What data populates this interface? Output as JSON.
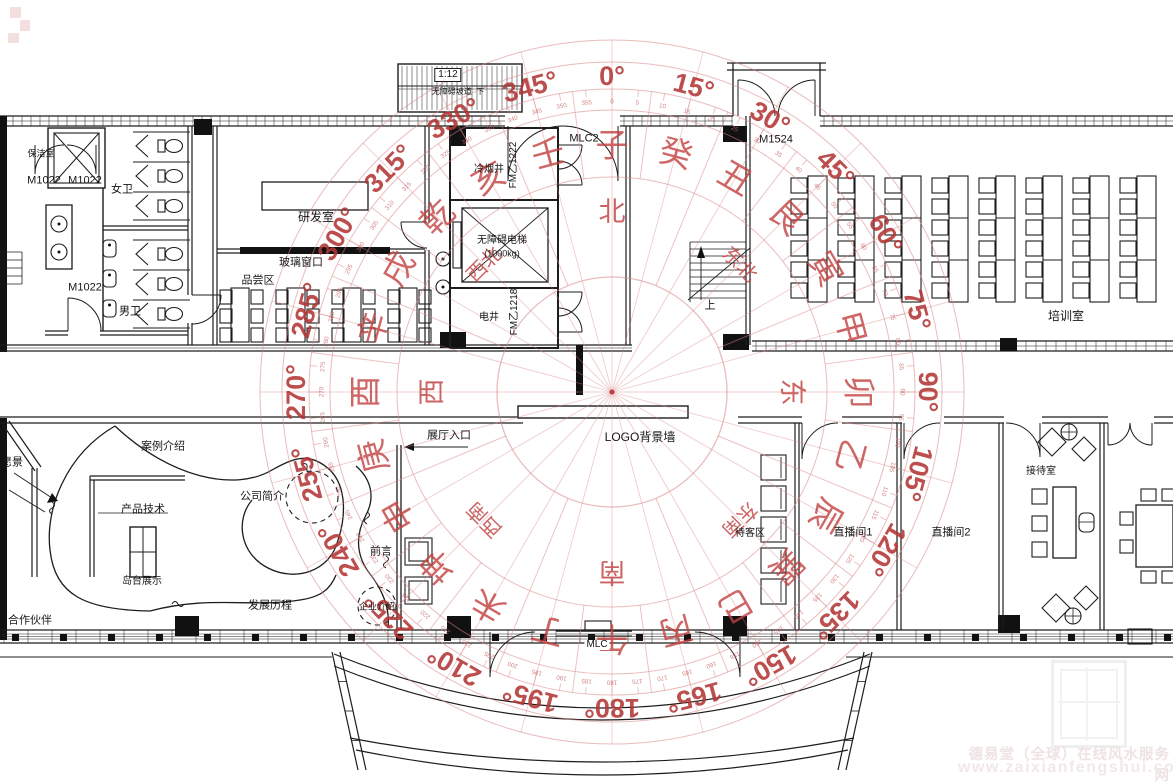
{
  "compass": {
    "center_x": 612,
    "center_y": 392,
    "circle_radii": [
      115,
      215,
      282,
      303,
      330,
      352
    ],
    "degree_step": 15,
    "minor_step": 5,
    "direction_radius": 180,
    "mountain_radius": 247,
    "degree_radius": 316,
    "minor_radius": 290,
    "degree_labels": [
      "0°",
      "15°",
      "30°",
      "45°",
      "60°",
      "75°",
      "90°",
      "105°",
      "120°",
      "135°",
      "150°",
      "165°",
      "180°",
      "195°",
      "210°",
      "225°",
      "240°",
      "255°",
      "270°",
      "285°",
      "300°",
      "315°",
      "330°",
      "345°"
    ],
    "mountains": [
      "子",
      "癸",
      "丑",
      "艮",
      "寅",
      "甲",
      "卯",
      "乙",
      "辰",
      "巽",
      "巳",
      "丙",
      "午",
      "丁",
      "未",
      "坤",
      "申",
      "庚",
      "酉",
      "辛",
      "戌",
      "乾",
      "亥",
      "壬"
    ],
    "directions": [
      "北",
      "东北",
      "东",
      "东南",
      "南",
      "西南",
      "西",
      "西北"
    ],
    "colors": {
      "ring": "#d98585",
      "direction_text": "#c24848",
      "mountain_text": "#c24040",
      "degree_text": "#b33535",
      "minor_text": "#c96a6a"
    }
  },
  "plan_labels": [
    {
      "id": "baojieshi",
      "text": "保洁室",
      "x": 41,
      "y": 154,
      "fs": 9
    },
    {
      "id": "door-m1022-1",
      "text": "M1022",
      "x": 44,
      "y": 181,
      "fs": 11
    },
    {
      "id": "door-m1022-2",
      "text": "M1022",
      "x": 85,
      "y": 181,
      "fs": 11
    },
    {
      "id": "door-m1022-3",
      "text": "M1022",
      "x": 85,
      "y": 288,
      "fs": 11
    },
    {
      "id": "nv-wei",
      "text": "女卫",
      "x": 122,
      "y": 190,
      "fs": 11
    },
    {
      "id": "nan-wei",
      "text": "男卫",
      "x": 130,
      "y": 312,
      "fs": 11
    },
    {
      "id": "yanfashi",
      "text": "研发室",
      "x": 316,
      "y": 217,
      "fs": 12
    },
    {
      "id": "boli-chuangkou",
      "text": "玻璃窗口",
      "x": 301,
      "y": 263,
      "fs": 11
    },
    {
      "id": "pinchangqu",
      "text": "品尝区",
      "x": 258,
      "y": 281,
      "fs": 11
    },
    {
      "id": "ramp-slope",
      "text": "1:12",
      "x": 448,
      "y": 75,
      "fs": 10,
      "style": "boxed"
    },
    {
      "id": "ramp-name",
      "text": "无障碍坡道  下",
      "x": 458,
      "y": 92,
      "fs": 8
    },
    {
      "id": "lengyanjing",
      "text": "冷烟井",
      "x": 489,
      "y": 170,
      "fs": 10
    },
    {
      "id": "door-fm1222",
      "text": "FM乙1222",
      "x": 514,
      "y": 165,
      "fs": 10,
      "rot": -90
    },
    {
      "id": "dianti",
      "text": "无障碍电梯",
      "x": 502,
      "y": 241,
      "fs": 10
    },
    {
      "id": "dianti-kg",
      "text": "(1000kg)",
      "x": 502,
      "y": 254,
      "fs": 9
    },
    {
      "id": "dianjing",
      "text": "电井",
      "x": 489,
      "y": 318,
      "fs": 10
    },
    {
      "id": "door-fm1218",
      "text": "FM乙1218",
      "x": 515,
      "y": 312,
      "fs": 10,
      "rot": -90
    },
    {
      "id": "door-mlc2",
      "text": "MLC2",
      "x": 584,
      "y": 139,
      "fs": 11
    },
    {
      "id": "door-m1524",
      "text": "M1524",
      "x": 776,
      "y": 140,
      "fs": 11
    },
    {
      "id": "stair-up",
      "text": "上",
      "x": 710,
      "y": 306,
      "fs": 11
    },
    {
      "id": "peixunshi",
      "text": "培训室",
      "x": 1066,
      "y": 316,
      "fs": 12
    },
    {
      "id": "logo-wall",
      "text": "LOGO背景墙",
      "x": 640,
      "y": 437,
      "fs": 12
    },
    {
      "id": "zhanting-rukou",
      "text": "展厅入口",
      "x": 449,
      "y": 436,
      "fs": 11
    },
    {
      "id": "qianyan",
      "text": "前言",
      "x": 381,
      "y": 552,
      "fs": 11
    },
    {
      "id": "gongsi-jianjie",
      "text": "公司简介",
      "x": 262,
      "y": 497,
      "fs": 11
    },
    {
      "id": "anli-jieshao",
      "text": "案例介绍",
      "x": 163,
      "y": 447,
      "fs": 11
    },
    {
      "id": "chanpin-jishu",
      "text": "产品技术",
      "x": 143,
      "y": 510,
      "fs": 11
    },
    {
      "id": "daotai-zhanshi",
      "text": "岛台展示",
      "x": 142,
      "y": 582,
      "fs": 10
    },
    {
      "id": "fazhan-licheng",
      "text": "发展历程",
      "x": 270,
      "y": 606,
      "fs": 11
    },
    {
      "id": "hezuo-huoban",
      "text": "合作伙伴",
      "x": 30,
      "y": 621,
      "fs": 11
    },
    {
      "id": "yuanjing",
      "text": "愿景",
      "x": 12,
      "y": 463,
      "fs": 11
    },
    {
      "id": "qiye-jieshao",
      "text": "企业介绍",
      "x": 377,
      "y": 607,
      "fs": 9
    },
    {
      "id": "door-mlc",
      "text": "MLC",
      "x": 597,
      "y": 645,
      "fs": 10,
      "style": "bg"
    },
    {
      "id": "daikequ",
      "text": "待客区",
      "x": 750,
      "y": 534,
      "fs": 10
    },
    {
      "id": "zhibojian1",
      "text": "直播间1",
      "x": 853,
      "y": 533,
      "fs": 11
    },
    {
      "id": "zhibojian2",
      "text": "直播间2",
      "x": 951,
      "y": 533,
      "fs": 11
    },
    {
      "id": "jiedaishi",
      "text": "接待室",
      "x": 1041,
      "y": 472,
      "fs": 10
    }
  ],
  "watermark": {
    "line1": "德易堂（全球）在线风水服务网",
    "line2": "www.zaixianfengshui.com"
  }
}
